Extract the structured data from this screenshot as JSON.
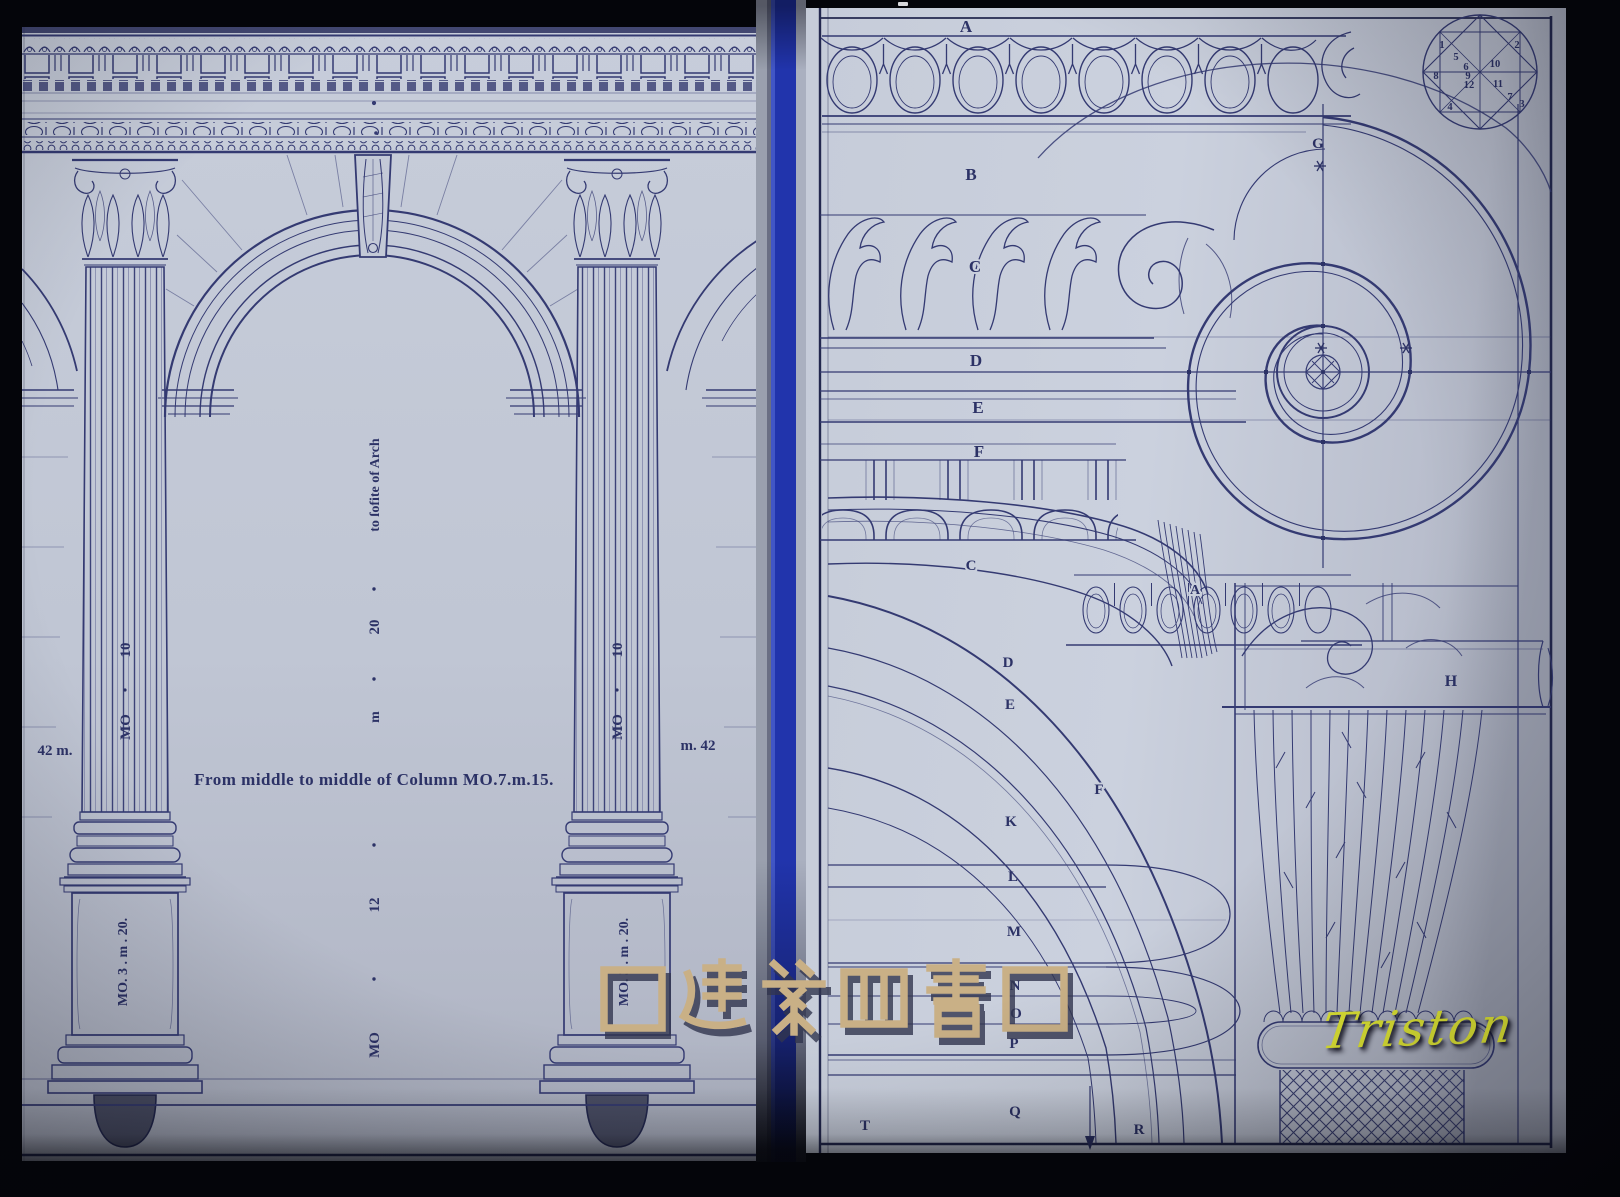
{
  "watermark": {
    "text": "囗建築四書囗",
    "color": "#c9b086"
  },
  "signature": {
    "text": "Triston",
    "color": "#ebf236"
  },
  "left_page": {
    "caption": "From middle to middle of Column MO.7.m.15.",
    "left_margin_dim": "42 m.",
    "right_margin_dim": "m. 42",
    "center_dim": {
      "lower_unit": "MO",
      "lower_value": "12",
      "upper_unit": "m",
      "upper_value": "20",
      "target": "to ſofite of Arch"
    },
    "left_column": {
      "shaft_value": "10",
      "shaft_unit": "MO",
      "pedestal_dim": "MO. 3 . m . 20."
    },
    "right_column": {
      "shaft_value": "10",
      "shaft_unit": "MO",
      "pedestal_dim": "MO. 3 . m . 20."
    }
  },
  "right_page": {
    "cornice_labels": {
      "a": "A",
      "b": "B",
      "c": "C",
      "d": "D",
      "e": "E",
      "f": "F"
    },
    "volute": {
      "axis_label": "G"
    },
    "abacus_label": "H",
    "ovolo_label": "A",
    "arch_labels": {
      "c": "C",
      "d": "D",
      "e": "E",
      "f": "F",
      "k": "K",
      "l": "L",
      "m": "M",
      "n": "N",
      "o": "O",
      "p": "P"
    },
    "base_labels": {
      "t": "T",
      "q": "Q",
      "r": "R"
    },
    "eye_diagram": {
      "numbers": [
        "1",
        "2",
        "3",
        "4",
        "5",
        "6",
        "7",
        "8",
        "9",
        "10",
        "11",
        "12"
      ]
    }
  }
}
